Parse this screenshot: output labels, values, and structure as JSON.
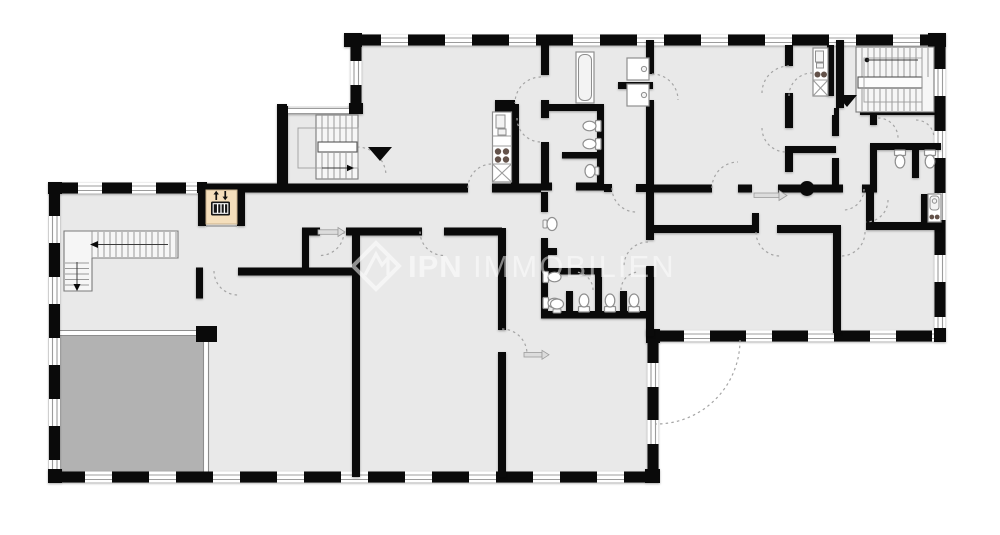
{
  "title": "building-floor-plan",
  "watermark": {
    "logo": "ipn-diamond-logo",
    "brand": "IPN",
    "brand_suffix": "IMMOBILIEN"
  },
  "colors": {
    "room_fill": "#e9e9e9",
    "room_dark": "#b2b2b2",
    "wall": "#0a0a0a",
    "window_line": "#9c9c9c",
    "door_arc": "#a5a5a5",
    "elevator_bg": "#f5dfbc",
    "fixture_stroke": "#8f8f8f",
    "burner": "#63524a",
    "watermark": "#ffffff"
  },
  "icons": [
    {
      "name": "elevator-icon"
    },
    {
      "name": "staircase-left-icon"
    },
    {
      "name": "staircase-center-icon"
    },
    {
      "name": "staircase-right-icon"
    },
    {
      "name": "entrance-arrow-center"
    },
    {
      "name": "entrance-arrow-right"
    },
    {
      "name": "column-dot"
    },
    {
      "name": "ipn-diamond-logo"
    }
  ],
  "fixtures": [
    {
      "name": "kitchen-unit-center"
    },
    {
      "name": "kitchen-unit-right"
    },
    {
      "name": "kitchenette-far-right"
    },
    {
      "name": "bathtub"
    },
    {
      "name": "shower-tray-upper"
    },
    {
      "name": "shower-tray-lower"
    },
    {
      "name": "wc-toilets-center"
    },
    {
      "name": "wc-toilets-right"
    },
    {
      "name": "washbasins"
    },
    {
      "name": "door-swing-arcs"
    }
  ]
}
